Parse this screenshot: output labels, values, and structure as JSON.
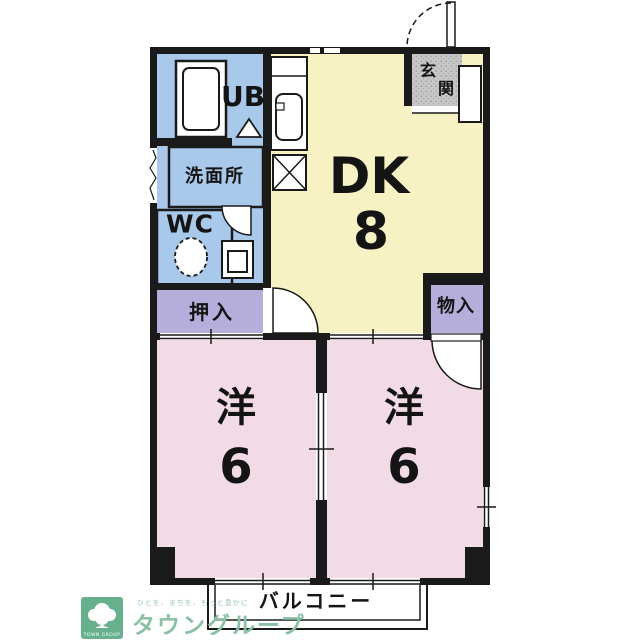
{
  "colors": {
    "wall": "#1a1a1a",
    "dk_yellow": "#f7f2c3",
    "bedroom_pink": "#f2dbe6",
    "wet_blue": "#a9c9ea",
    "closet_purple": "#b5aedb",
    "entrance_gray": "#c7c7c7",
    "brand_green": "#66b08d",
    "brand_text_green": "#8cc0a6"
  },
  "rooms": {
    "dk": {
      "label": "DK",
      "size": "8"
    },
    "bedroom_left": {
      "label": "洋",
      "size": "6"
    },
    "bedroom_right": {
      "label": "洋",
      "size": "6"
    },
    "unit_bath": {
      "label": "UB"
    },
    "washroom": {
      "label": "洗面所"
    },
    "toilet": {
      "label": "WC"
    },
    "entrance": {
      "char1": "玄",
      "char2": "関"
    },
    "closet": {
      "label": "押入"
    },
    "storage": {
      "label": "物入"
    },
    "balcony": {
      "label": "バルコニー"
    }
  },
  "branding": {
    "logo_text": "TOWN GROUP",
    "tagline": "ひとを、まちを、もっと豊かに",
    "brand_name": "タウングループ"
  }
}
